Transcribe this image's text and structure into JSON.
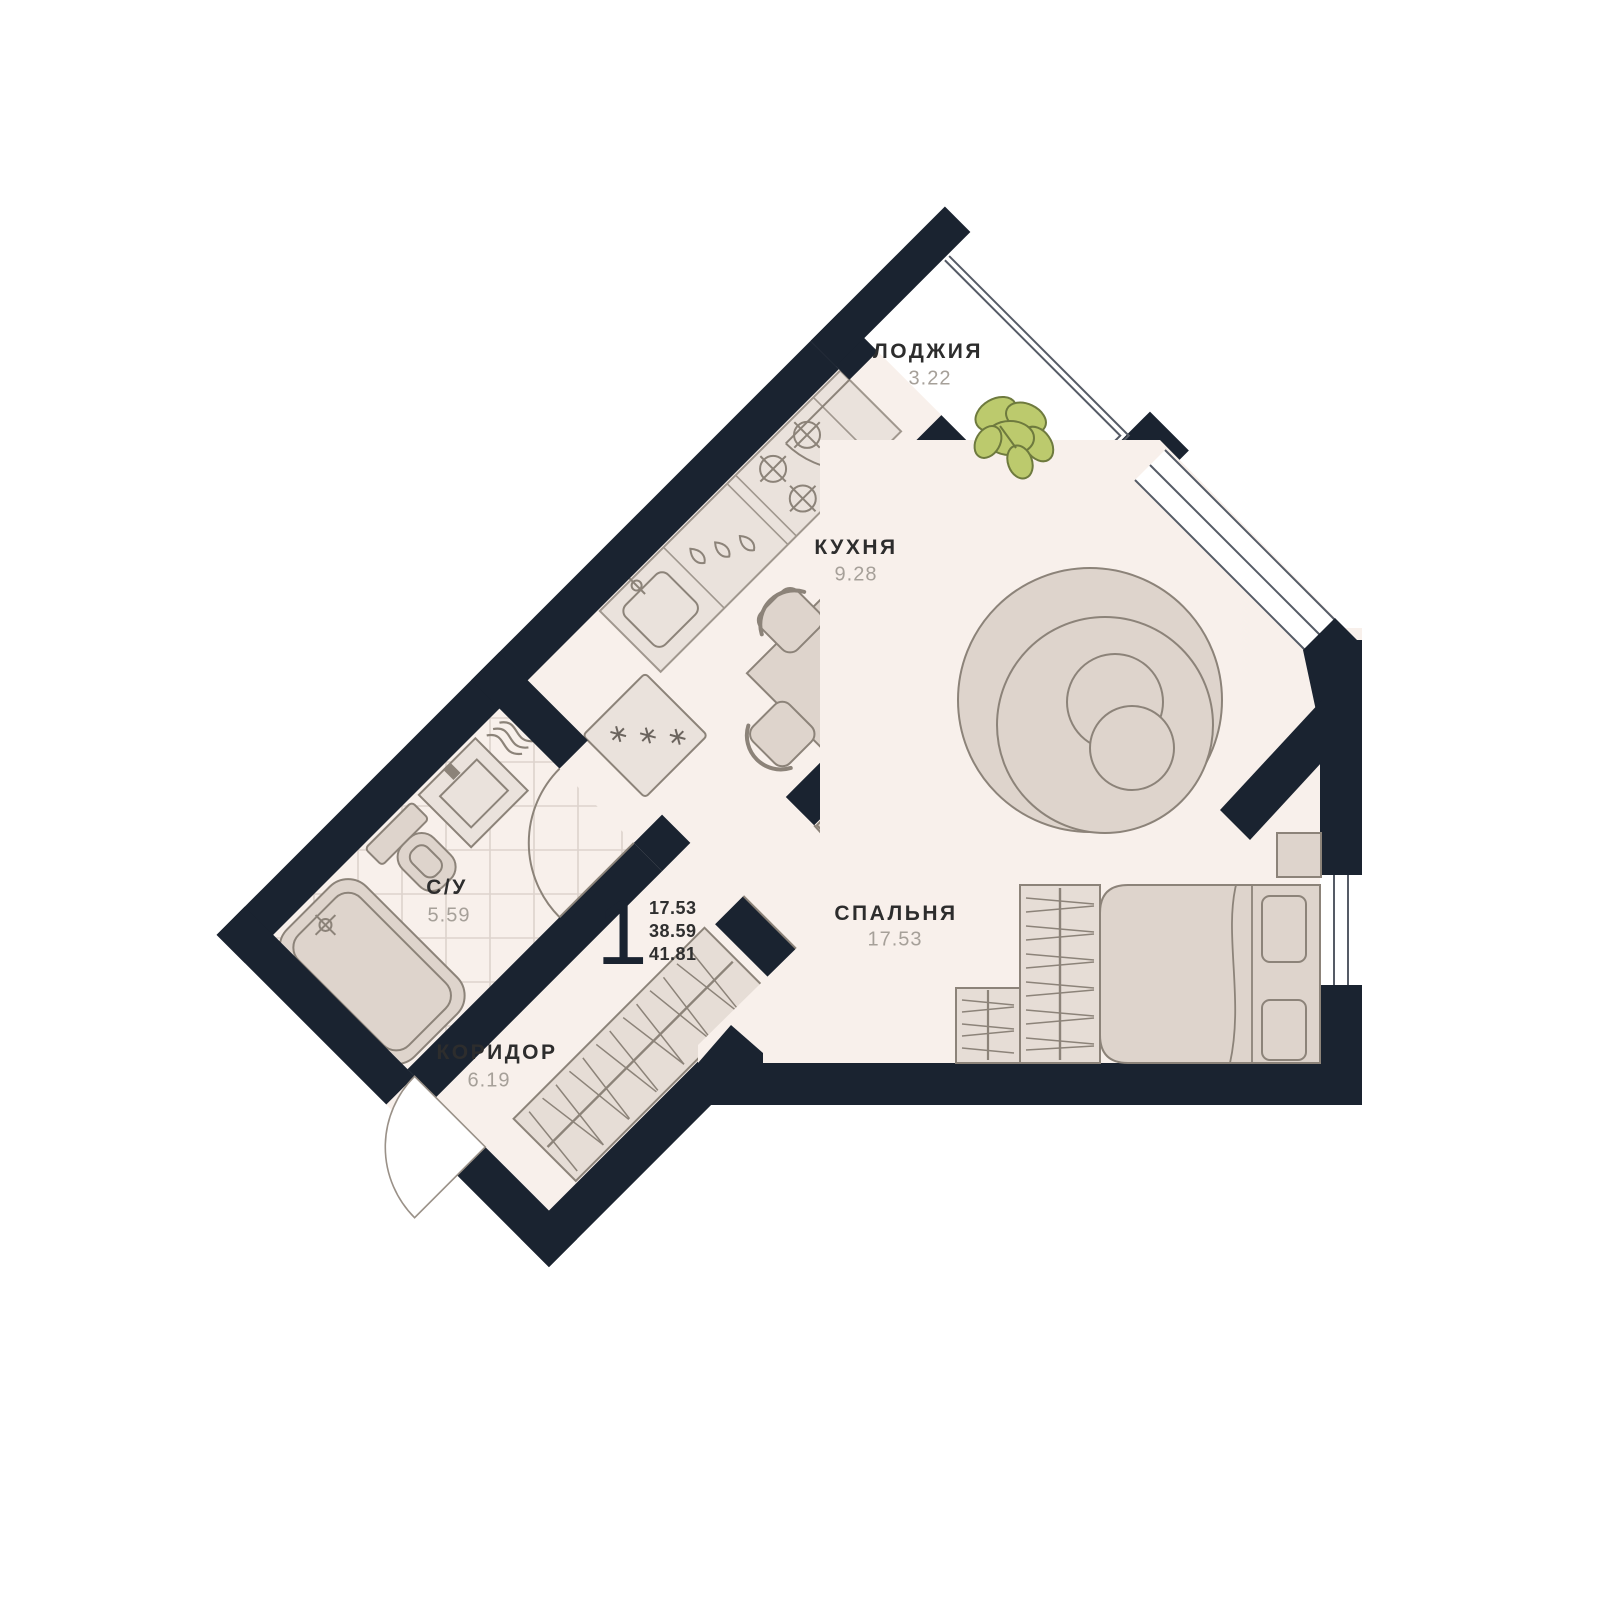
{
  "plan": {
    "unit": {
      "number": "1",
      "area_lines": [
        "17.53",
        "38.59",
        "41.81"
      ]
    },
    "rooms": [
      {
        "id": "loggia",
        "name": "ЛОДЖИЯ",
        "area": "3.22"
      },
      {
        "id": "kitchen",
        "name": "КУХНЯ",
        "area": "9.28"
      },
      {
        "id": "bathroom",
        "name": "С/У",
        "area": "5.59"
      },
      {
        "id": "corridor",
        "name": "КОРИДОР",
        "area": "6.19"
      },
      {
        "id": "bedroom",
        "name": "СПАЛЬНЯ",
        "area": "17.53"
      }
    ],
    "colors": {
      "wall": "#1a2330",
      "floor": "#f8f0eb",
      "loggia_floor": "#ffffff",
      "furniture": "#ded4cc",
      "furniture_outline": "#8c8379",
      "counter": "#eae2dc",
      "wardrobe": "#e6ddd6",
      "tile_line": "#ddd3cc",
      "glazing_line": "#555b66",
      "plant": "#bcca6d",
      "plant_outline": "#6e7a3e",
      "room_label": "#2d2d2d",
      "area_label": "#a6a099"
    }
  }
}
